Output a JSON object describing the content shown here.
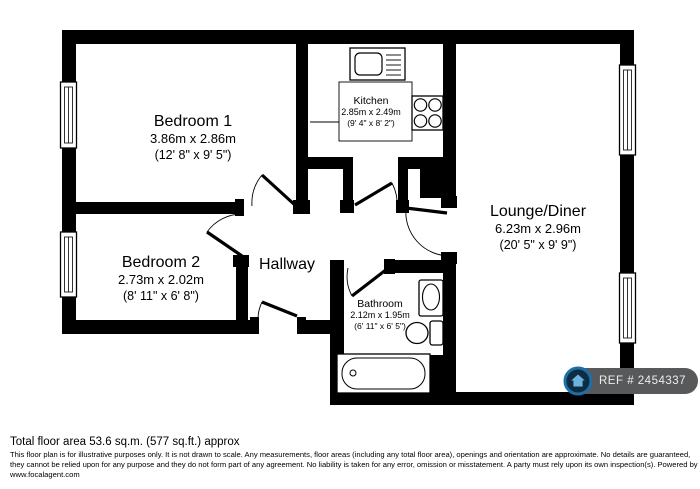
{
  "floor_plan": {
    "rooms": [
      {
        "id": "bedroom-1",
        "name": "Bedroom 1",
        "metric": "3.86m x 2.86m",
        "imperial": "(12' 8\" x 9' 5\")"
      },
      {
        "id": "kitchen",
        "name": "Kitchen",
        "metric": "2.85m x 2.49m",
        "imperial": "(9' 4\" x 8' 2\")"
      },
      {
        "id": "lounge-diner",
        "name": "Lounge/Diner",
        "metric": "6.23m x 2.96m",
        "imperial": "(20' 5\" x 9' 9\")"
      },
      {
        "id": "bedroom-2",
        "name": "Bedroom 2",
        "metric": "2.73m x 2.02m",
        "imperial": "(8' 11\" x 6' 8\")"
      },
      {
        "id": "hallway",
        "name": "Hallway"
      },
      {
        "id": "bathroom",
        "name": "Bathroom",
        "metric": "2.12m x 1.95m",
        "imperial": "(6' 11\" x 6' 5\")"
      }
    ],
    "fixtures": [
      "kitchen-sink",
      "hob",
      "basin",
      "toilet",
      "bathtub"
    ],
    "wall_color": "#000000",
    "floor_color": "#ffffff",
    "ref_badge": {
      "label": "REF # 2454337",
      "icon": "house-icon",
      "pill_color": "#58595b",
      "icon_ring_color": "#1e6fa8",
      "icon_background_color": "#0e2c42",
      "icon_glyph_color": "#6db3e0"
    }
  },
  "footer": {
    "total_area": "Total floor area 53.6 sq.m. (577 sq.ft.) approx",
    "disclaimer_lines": [
      "This floor plan is for illustrative purposes only. It is not drawn to scale. Any measurements, floor areas (including any total floor area), openings and orientation are approximate. No details are guaranteed,",
      "they cannot be relied upon for any purpose and they do not form part of any agreement. No liability is taken for any error, omission or misstatement. A party must rely upon its own inspection(s). Powered by",
      "www.focalagent.com"
    ]
  }
}
